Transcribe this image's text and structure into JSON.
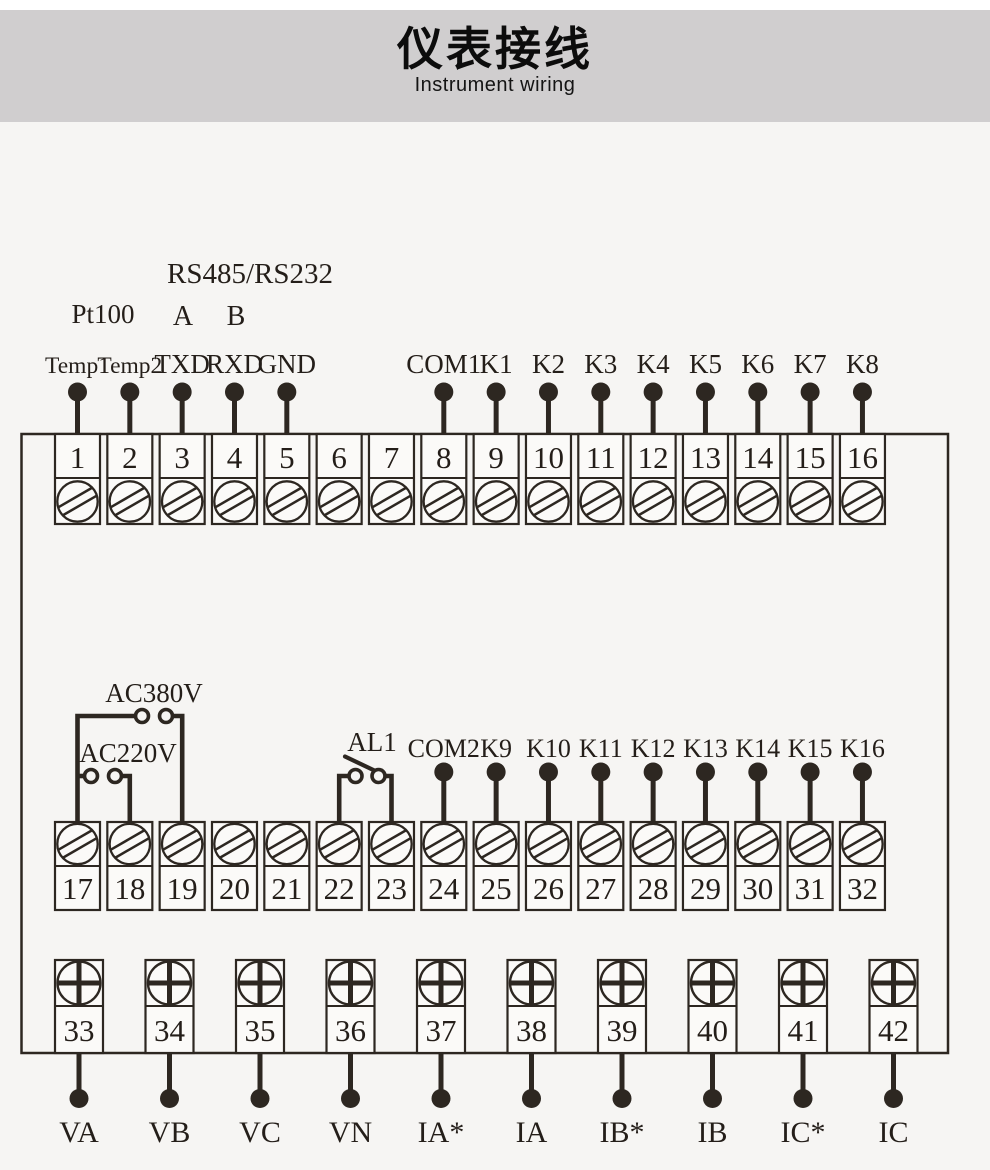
{
  "header": {
    "title_cn": "仪表接线",
    "title_en": "Instrument wiring"
  },
  "colors": {
    "ink": "#2d2721",
    "text": "#241e19",
    "header_band": "#d0cecf",
    "background": "#f6f5f3",
    "box_fill": "#fbfaf8"
  },
  "diagram": {
    "top_labels": {
      "pt100": "Pt100",
      "bus": "RS485/RS232",
      "a": "A",
      "b": "B"
    },
    "power": {
      "ac380": "AC380V",
      "ac220": "AC220V",
      "alarm": "AL1"
    },
    "row1": {
      "terminals": [
        "1",
        "2",
        "3",
        "4",
        "5",
        "6",
        "7",
        "8",
        "9",
        "10",
        "11",
        "12",
        "13",
        "14",
        "15",
        "16"
      ],
      "pins": [
        {
          "t": 1,
          "label": "Temp1"
        },
        {
          "t": 2,
          "label": "Temp2"
        },
        {
          "t": 3,
          "label": "TXD"
        },
        {
          "t": 4,
          "label": "RXD"
        },
        {
          "t": 5,
          "label": "GND"
        },
        {
          "t": 8,
          "label": "COM1"
        },
        {
          "t": 9,
          "label": "K1"
        },
        {
          "t": 10,
          "label": "K2"
        },
        {
          "t": 11,
          "label": "K3"
        },
        {
          "t": 12,
          "label": "K4"
        },
        {
          "t": 13,
          "label": "K5"
        },
        {
          "t": 14,
          "label": "K6"
        },
        {
          "t": 15,
          "label": "K7"
        },
        {
          "t": 16,
          "label": "K8"
        }
      ]
    },
    "row2": {
      "terminals": [
        "17",
        "18",
        "19",
        "20",
        "21",
        "22",
        "23",
        "24",
        "25",
        "26",
        "27",
        "28",
        "29",
        "30",
        "31",
        "32"
      ],
      "pins": [
        {
          "t": 24,
          "label": "COM2"
        },
        {
          "t": 25,
          "label": "K9"
        },
        {
          "t": 26,
          "label": "K10"
        },
        {
          "t": 27,
          "label": "K11"
        },
        {
          "t": 28,
          "label": "K12"
        },
        {
          "t": 29,
          "label": "K13"
        },
        {
          "t": 30,
          "label": "K14"
        },
        {
          "t": 31,
          "label": "K15"
        },
        {
          "t": 32,
          "label": "K16"
        }
      ]
    },
    "row3": {
      "terminals": [
        "33",
        "34",
        "35",
        "36",
        "37",
        "38",
        "39",
        "40",
        "41",
        "42"
      ],
      "pins": [
        "VA",
        "VB",
        "VC",
        "VN",
        "IA*",
        "IA",
        "IB*",
        "IB",
        "IC*",
        "IC"
      ]
    }
  }
}
